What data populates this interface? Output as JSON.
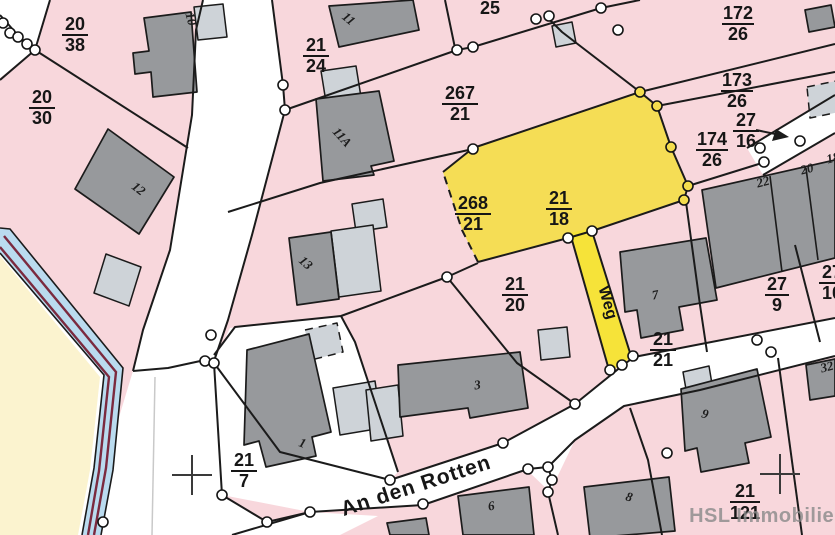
{
  "map": {
    "street_name": "An den Rotten",
    "path_label": "Weg",
    "watermark": "HSL Immobilien",
    "plain_labels": [
      {
        "text": "25"
      }
    ],
    "parcel_labels": [
      {
        "num": "20",
        "den": "38"
      },
      {
        "num": "20",
        "den": "30"
      },
      {
        "num": "21",
        "den": "24"
      },
      {
        "num": "267",
        "den": "21"
      },
      {
        "num": "172",
        "den": "26"
      },
      {
        "num": "173",
        "den": "26"
      },
      {
        "num": "27",
        "den": "16"
      },
      {
        "num": "174",
        "den": "26"
      },
      {
        "num": "268",
        "den": "21"
      },
      {
        "num": "21",
        "den": "18"
      },
      {
        "num": "21",
        "den": "20"
      },
      {
        "num": "27",
        "den": "9"
      },
      {
        "num": "27",
        "den": "10"
      },
      {
        "num": "21",
        "den": "21"
      },
      {
        "num": "21",
        "den": "7"
      },
      {
        "num": "21",
        "den": "121"
      }
    ],
    "building_labels": [
      {
        "text": "10"
      },
      {
        "text": "11"
      },
      {
        "text": "11A"
      },
      {
        "text": "12"
      },
      {
        "text": "13"
      },
      {
        "text": "1"
      },
      {
        "text": "3"
      },
      {
        "text": "6"
      },
      {
        "text": "7"
      },
      {
        "text": "8"
      },
      {
        "text": "9"
      },
      {
        "text": "22"
      },
      {
        "text": "20"
      },
      {
        "text": "18"
      },
      {
        "text": "32"
      }
    ],
    "colors": {
      "parcel_pink": "#f8d7dc",
      "highlight_yellow": "#f4dd4d",
      "path_yellow": "#f6e339",
      "stream_blue": "#badbef",
      "stream_red": "#7b2a3f",
      "meadow_beige": "#fbf3cf",
      "building_grey": "#97999c",
      "annex_grey": "#ced3d8"
    }
  }
}
